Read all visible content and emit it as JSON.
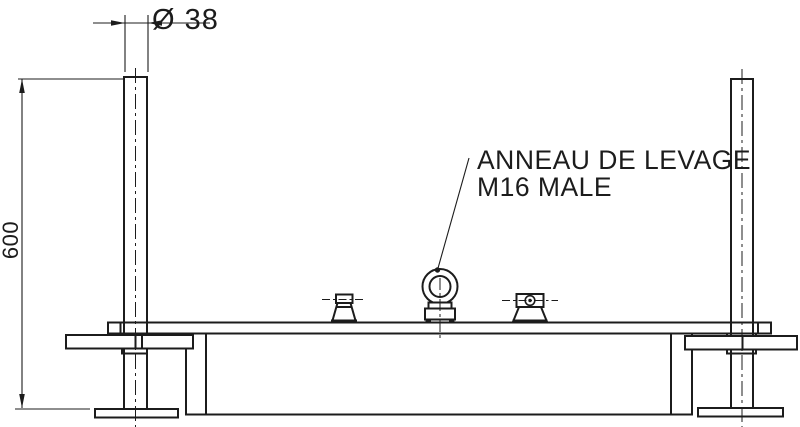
{
  "drawing": {
    "title": "lifting-frame-elevation-view",
    "callout": {
      "line1": "ANNEAU DE LEVAGE",
      "line2": "M16 MALE"
    },
    "dimensions": {
      "diameter": "Ø 38",
      "height": "600"
    },
    "colors": {
      "line": "#1c1c1c",
      "background": "#ffffff"
    }
  }
}
